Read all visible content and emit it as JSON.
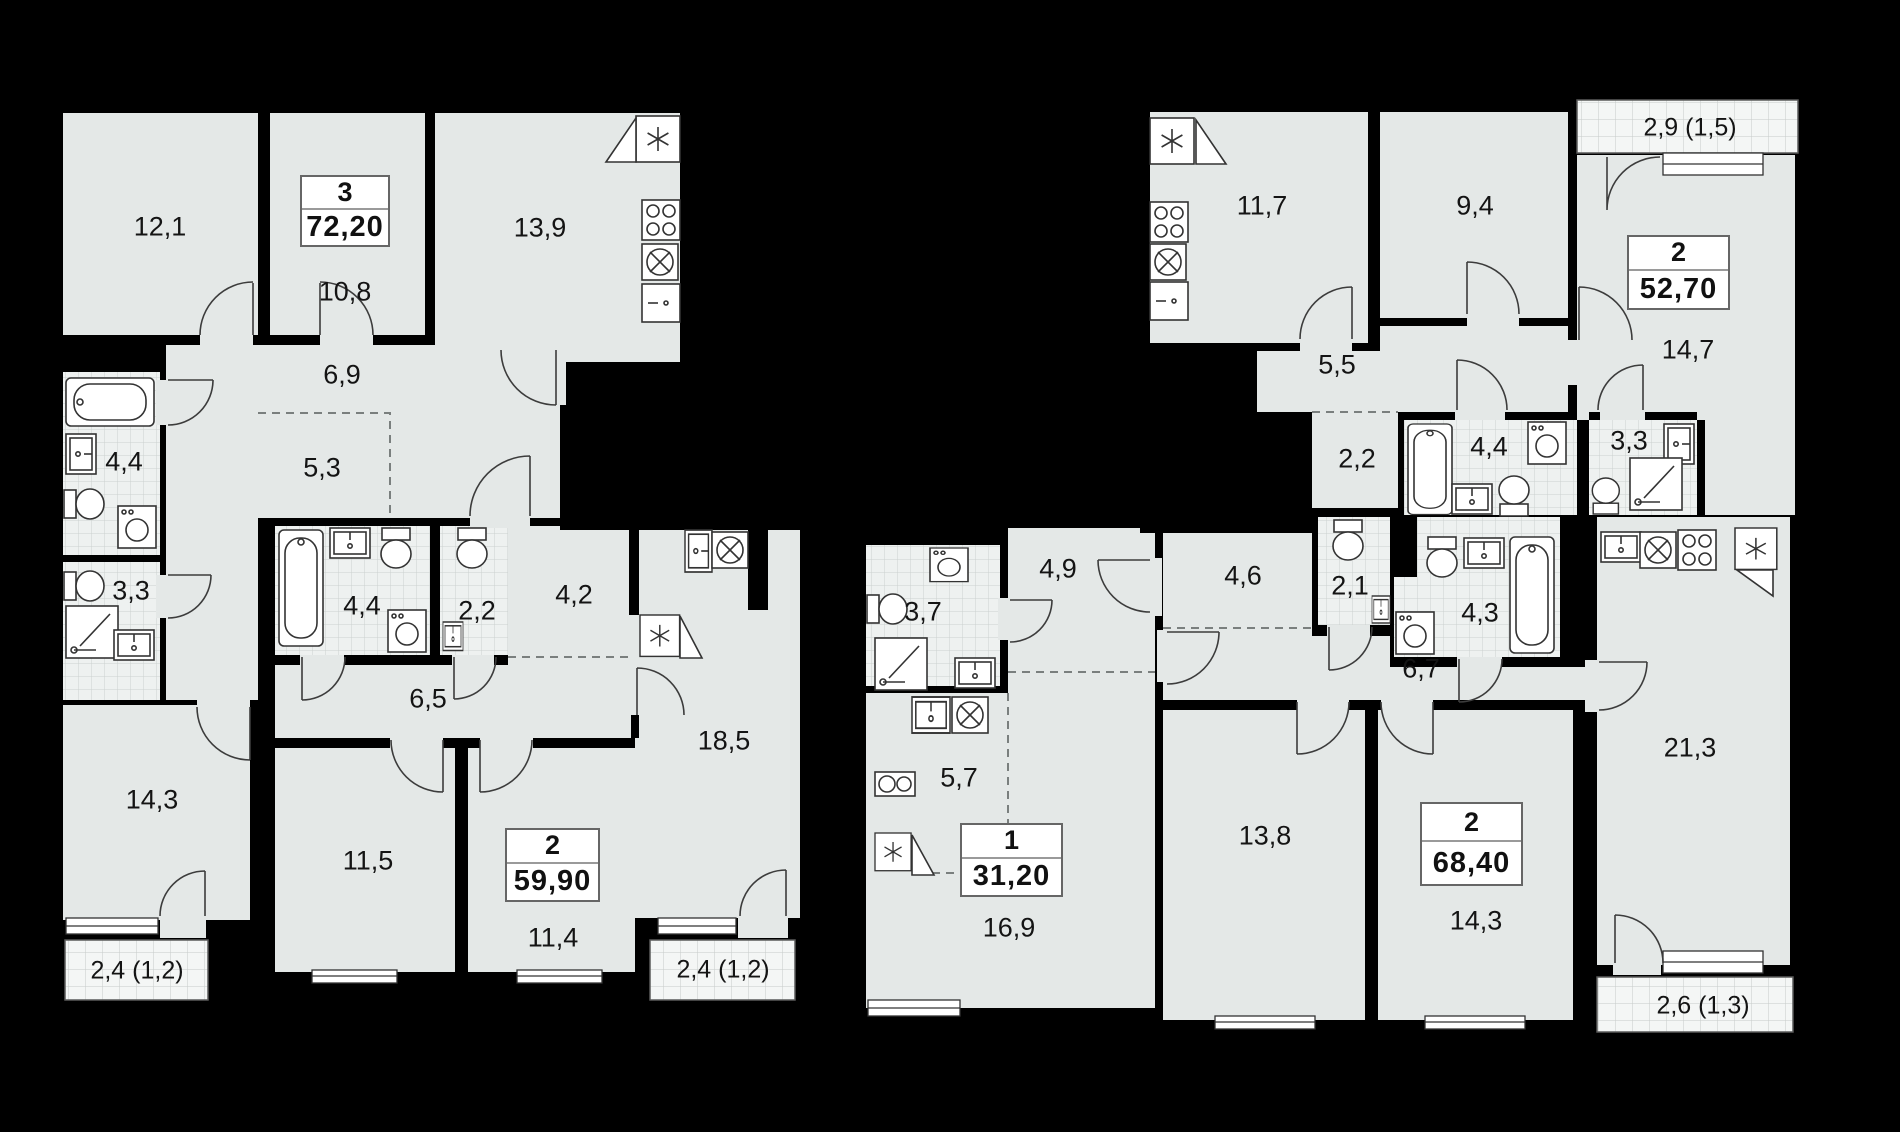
{
  "plan": {
    "type": "residential-floor-plan",
    "background_color": "#000000",
    "room_fill_color": "#e4e8e7",
    "wet_room_fill_color": "#eef1f0",
    "balcony_fill_color": "#f4f6f5",
    "apartments": [
      {
        "name": "3-room apartment",
        "rooms_count": "3",
        "total_area": "72,20",
        "rooms": [
          {
            "type": "bedroom",
            "area": "12,1"
          },
          {
            "type": "bedroom",
            "area": "10,8"
          },
          {
            "type": "kitchen",
            "area": "13,9"
          },
          {
            "type": "corridor",
            "area": "6,9"
          },
          {
            "type": "hallway",
            "area": "5,3"
          },
          {
            "type": "bathroom",
            "area": "4,4"
          },
          {
            "type": "wc",
            "area": "3,3"
          },
          {
            "type": "living-room",
            "area": "14,3"
          }
        ],
        "balcony": {
          "area_label": "2,4 (1,2)"
        }
      },
      {
        "name": "2-room apartment",
        "rooms_count": "2",
        "total_area": "59,90",
        "rooms": [
          {
            "type": "bathroom",
            "area": "4,4"
          },
          {
            "type": "wc",
            "area": "2,2"
          },
          {
            "type": "hallway",
            "area": "4,2"
          },
          {
            "type": "corridor",
            "area": "6,5"
          },
          {
            "type": "bedroom",
            "area": "11,5"
          },
          {
            "type": "bedroom",
            "area": "11,4"
          },
          {
            "type": "kitchen-living",
            "area": "18,5"
          }
        ],
        "balcony": {
          "area_label": "2,4 (1,2)"
        }
      },
      {
        "name": "1-room apartment",
        "rooms_count": "1",
        "total_area": "31,20",
        "rooms": [
          {
            "type": "bathroom",
            "area": "3,7"
          },
          {
            "type": "hallway",
            "area": "4,9"
          },
          {
            "type": "kitchen-niche",
            "area": "5,7"
          },
          {
            "type": "living-room",
            "area": "16,9"
          }
        ]
      },
      {
        "name": "2-room apartment",
        "rooms_count": "2",
        "total_area": "52,70",
        "rooms": [
          {
            "type": "kitchen",
            "area": "11,7"
          },
          {
            "type": "bedroom",
            "area": "9,4"
          },
          {
            "type": "hallway",
            "area": "5,5"
          },
          {
            "type": "wardrobe",
            "area": "2,2"
          },
          {
            "type": "bathroom",
            "area": "4,4"
          },
          {
            "type": "shower-wc",
            "area": "3,3"
          },
          {
            "type": "living-room",
            "area": "14,7"
          }
        ],
        "balcony": {
          "area_label": "2,9 (1,5)"
        }
      },
      {
        "name": "2-room apartment",
        "rooms_count": "2",
        "total_area": "68,40",
        "rooms": [
          {
            "type": "hallway",
            "area": "4,6"
          },
          {
            "type": "wc",
            "area": "2,1"
          },
          {
            "type": "bathroom",
            "area": "4,3"
          },
          {
            "type": "corridor",
            "area": "6,7"
          },
          {
            "type": "bedroom",
            "area": "13,8"
          },
          {
            "type": "bedroom",
            "area": "14,3"
          },
          {
            "type": "kitchen-living",
            "area": "21,3"
          }
        ],
        "balcony": {
          "area_label": "2,6 (1,3)"
        }
      }
    ],
    "icons": {
      "fridge-icon": "asterisk box with open flap",
      "stove-icon": "box with four burner circles",
      "hob-icon": "box with two burner circles",
      "kitchen-sink-icon": "box with crossed circle",
      "washbasin-icon": "box with tap",
      "bathtub-icon": "rounded tub outline",
      "shower-icon": "square with diagonal and drain",
      "toilet-icon": "tank and bowl",
      "washer-icon": "box with round door",
      "cabinet-icon": "box with handle"
    }
  }
}
